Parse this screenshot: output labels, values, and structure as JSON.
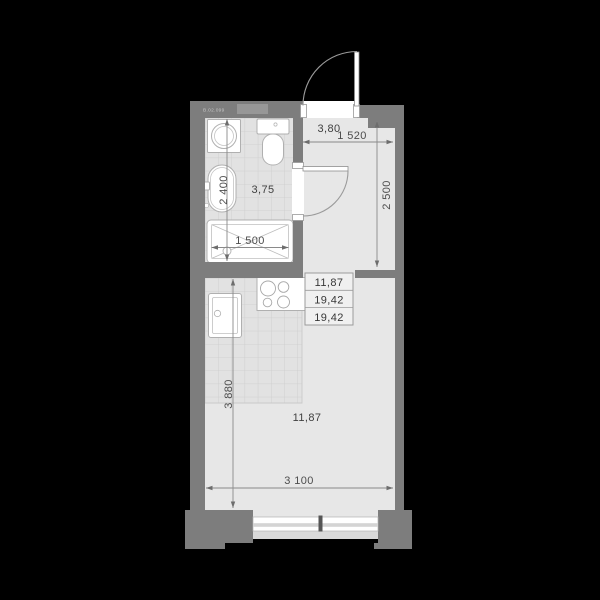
{
  "unit": {
    "label": "В.02.099"
  },
  "labels": {
    "bathroom_area": "3,75",
    "hall_area": "3,80",
    "room_area": "11,87"
  },
  "dimensions": {
    "bathroom_depth": "2 400",
    "bathtub_length": "1 500",
    "hall_width": "1 520",
    "hall_depth": "2 500",
    "room_depth": "3 880",
    "room_width": "3 100"
  },
  "area_table": {
    "rows": [
      "11,87",
      "19,42",
      "19,42"
    ]
  },
  "colors": {
    "background": "#000000",
    "wall": "#7d7d7d",
    "floor": "#e7e7e7",
    "tile_floor": "#e2e2e2",
    "tile_line": "#cccccc",
    "fixture_fill": "#ffffff",
    "dimension_text": "#4d4d4d",
    "window_tick": "#555555"
  }
}
